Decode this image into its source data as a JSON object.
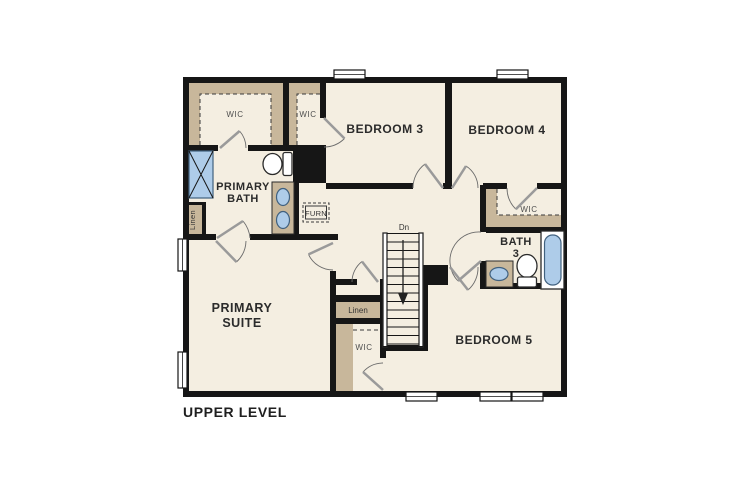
{
  "page": {
    "background": "#ffffff"
  },
  "floor_plan": {
    "level_label": "UPPER LEVEL",
    "palette": {
      "wall": "#161616",
      "floor": "#f4eee1",
      "closet_shelving": "#c8b79b",
      "fixture_blue": "#aecce9",
      "door_leaf": "#9a9a9a",
      "label_dark": "#2b2b2b",
      "label_gray": "#4f4f4f"
    },
    "labels": {
      "primary_suite_line1": "PRIMARY",
      "primary_suite_line2": "SUITE",
      "primary_bath_line1": "PRIMARY",
      "primary_bath_line2": "BATH",
      "bedroom3": "BEDROOM 3",
      "bedroom4": "BEDROOM 4",
      "bedroom5": "BEDROOM 5",
      "bath3_line1": "BATH",
      "bath3_line2": "3",
      "wic_primary": "WIC",
      "wic_bedroom3": "WIC",
      "wic_bedroom4": "WIC",
      "wic_bedroom5": "WIC",
      "linen_upper": "Linen",
      "linen_lower": "Linen",
      "furnace": "FURN",
      "stairs": "Dn"
    },
    "fixtures": [
      "shower",
      "toilet",
      "double-vanity",
      "sink",
      "bathtub",
      "stairs-down",
      "window",
      "linen-closet",
      "furnace-closet"
    ]
  }
}
